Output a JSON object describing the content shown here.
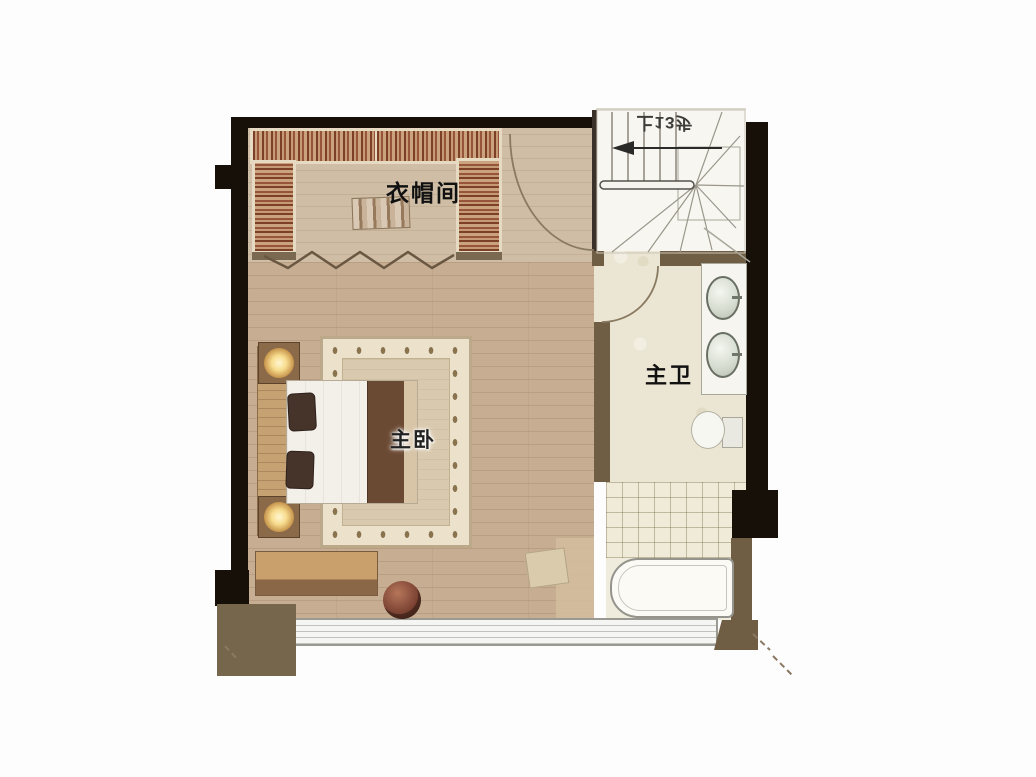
{
  "plan_title": "duplex-upper-floor-plan",
  "rooms": {
    "cloakroom": {
      "label": "衣帽间"
    },
    "master_bedroom": {
      "label": "主卧"
    },
    "master_bathroom": {
      "label": "主卫"
    }
  },
  "stairs": {
    "note": "上13步"
  },
  "colors": {
    "wall_dark": "#171009",
    "wall_brown": "#6f5e44",
    "bedroom_floor": "#c7ae93",
    "closet_floor": "#cfbda5",
    "bath_floor": "#ebe6d3",
    "wardrobe_stripe": "#7c3f28",
    "lamp_glow": "#fff7d2",
    "rug_border": "#ece2cb",
    "rug_center": "#d9c9ae",
    "window_band": "#f5f5f3",
    "exterior_block": "#76674c"
  }
}
